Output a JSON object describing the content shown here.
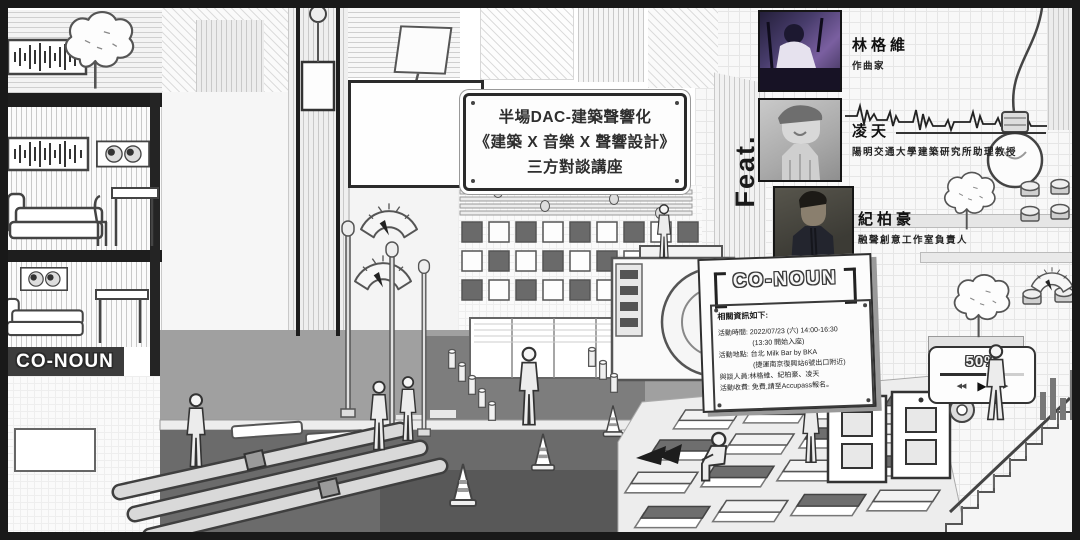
{
  "billboard": {
    "lines": [
      "半場DAC-建築聲響化",
      "《建築 X 音樂 X 聲響設計》",
      "三方對談講座"
    ]
  },
  "feat": {
    "label": "Feat."
  },
  "speakers": [
    {
      "name": "林格維",
      "title": "作曲家",
      "photo": "composer-at-synth-purple-stage-lighting"
    },
    {
      "name": "凌天",
      "title": "陽明交通大學建築研究所助理教授",
      "photo": "man-with-flat-cap-black-and-white"
    },
    {
      "name": "紀柏豪",
      "title": "融聲創意工作室負責人",
      "photo": "man-in-dark-jacket-grey-wall"
    }
  ],
  "info_board": {
    "brand": "CO-NOUN",
    "heading": "相關資訊如下:",
    "lines": [
      "活動時間: 2022/07/23 (六) 14:00-16:30",
      "(13:30 開始入座)",
      "活動地點: 台北 Milk Bar by BKA",
      "(捷運南京復興站6號出口附近)",
      "與談人員:林格維、紀柏豪、凌天",
      "活動收費: 免費,請至Accupass報名。"
    ]
  },
  "street_sign": {
    "brand": "CO-NOUN"
  },
  "player": {
    "percent": "50%",
    "rewind": "◀◀",
    "play": "▶",
    "forward": "▶▶"
  },
  "colors": {
    "ink": "#1a1a1a",
    "street": "#a0a0a0",
    "plaza": "#7d7d7d",
    "underground": "#686868",
    "photo1_accent": "#6e5a96",
    "band": "#3c3c3c"
  }
}
